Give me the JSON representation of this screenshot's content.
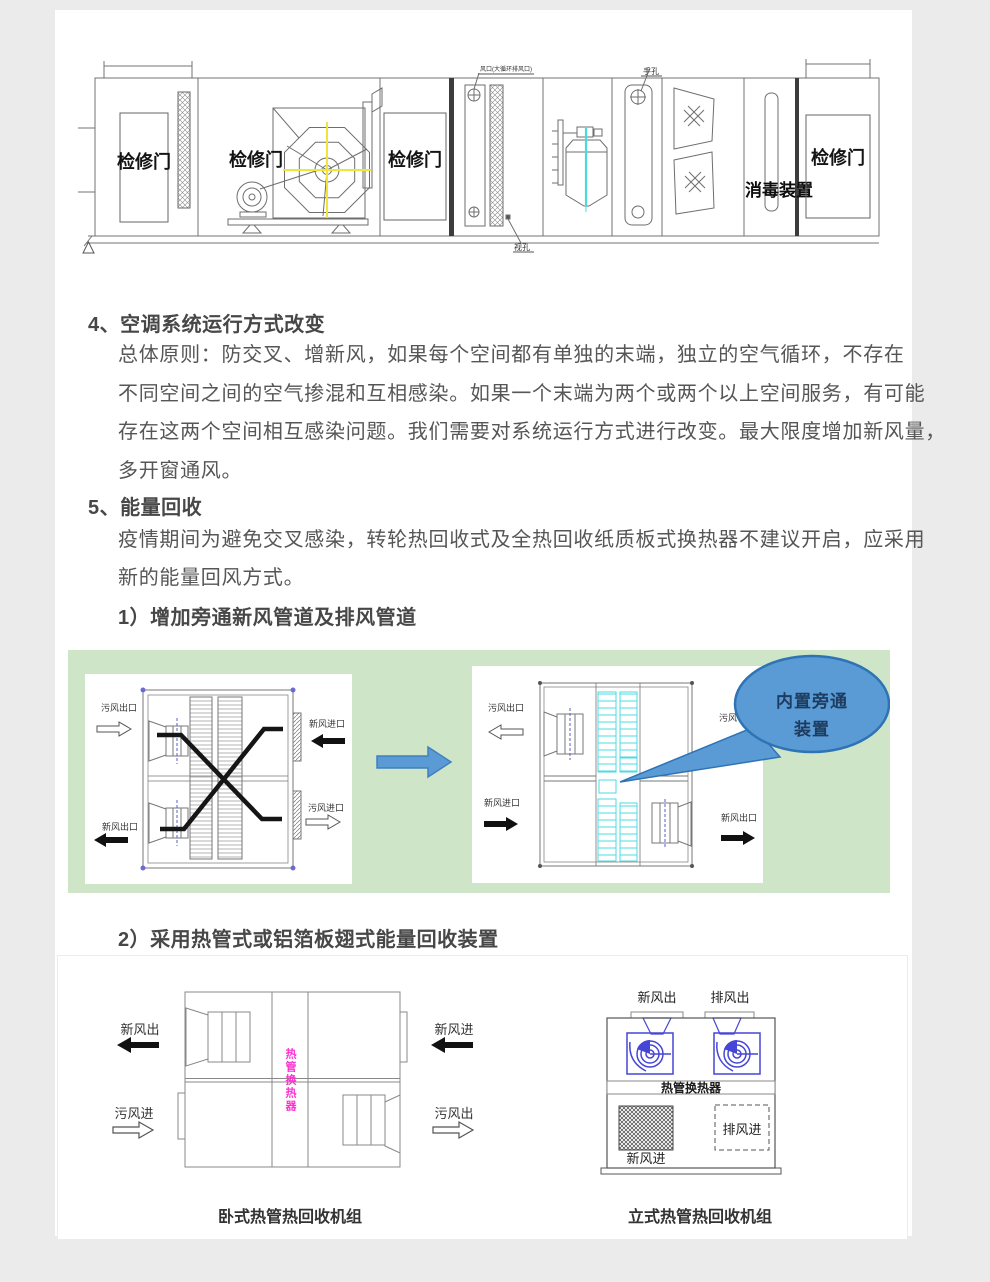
{
  "ahu": {
    "door_label": "检修门",
    "disinfection_label": "消毒装置",
    "annotation_top": "风口(大循环排风口)",
    "hand_hole": "手孔",
    "sight_hole": "视孔"
  },
  "section4": {
    "heading": "4、空调系统运行方式改变",
    "lines": [
      "总体原则：防交叉、增新风，如果每个空间都有单独的末端，独立的空气循环，不存在",
      "不同空间之间的空气掺混和互相感染。如果一个末端为两个或两个以上空间服务，有可能",
      "存在这两个空间相互感染问题。我们需要对系统运行方式进行改变。最大限度增加新风量，",
      "多开窗通风。"
    ]
  },
  "section5": {
    "heading": "5、能量回收",
    "lines": [
      "疫情期间为避免交叉感染，转轮热回收式及全热回收纸质板式换热器不建议开启，应采用",
      "新的能量回风方式。"
    ],
    "sub1": "1）增加旁通新风管道及排风管道",
    "sub2": "2）采用热管式或铝箔板翅式能量回收装置"
  },
  "figure1": {
    "left_unit": {
      "top_left": "污风出口",
      "top_right": "新风进口",
      "bottom_left": "新风出口",
      "bottom_right": "污风进口"
    },
    "right_unit": {
      "top_left": "污风出口",
      "mid_left": "新风进口",
      "top_right": "污风",
      "bottom_right": "新风出口"
    },
    "bubble_line1": "内置旁通",
    "bubble_line2": "装置"
  },
  "figure2": {
    "horizontal_unit": {
      "out_fresh": "新风出",
      "in_foul": "污风进",
      "in_fresh": "新风进",
      "out_foul": "污风出",
      "core": "热管换热器",
      "caption": "卧式热管热回收机组"
    },
    "vertical_unit": {
      "top_fresh_out": "新风出",
      "top_exhaust_out": "排风出",
      "core": "热管换热器",
      "fresh_in": "新风进",
      "exhaust_in": "排风进",
      "caption": "立式热管热回收机组"
    }
  },
  "colors": {
    "accent_blue": "#5b9bd5",
    "bubble_border": "#2e74b5",
    "panel_green": "#cfe5c7",
    "magenta": "#ff30d0",
    "cyan": "#49dbe0",
    "fan_blue": "#4646d6"
  }
}
